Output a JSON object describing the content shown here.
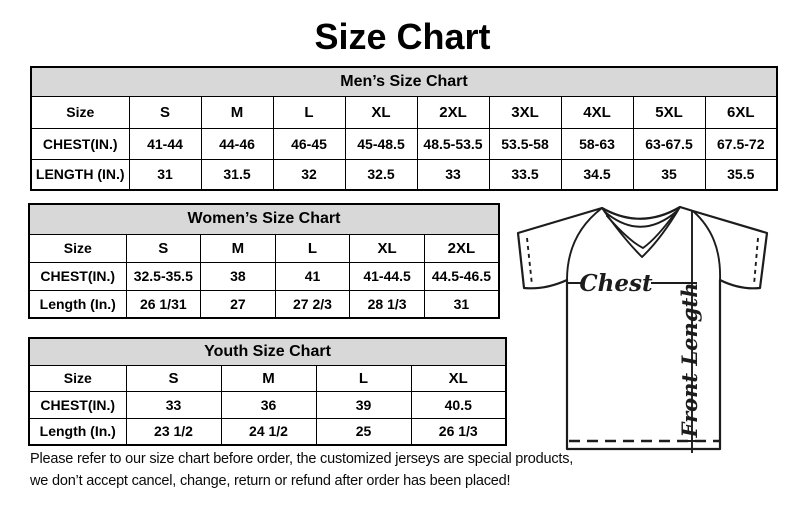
{
  "page": {
    "title": "Size Chart"
  },
  "tables": {
    "men": {
      "header": "Men’s Size Chart",
      "size_label": "Size",
      "sizes": [
        "S",
        "M",
        "L",
        "XL",
        "2XL",
        "3XL",
        "4XL",
        "5XL",
        "6XL"
      ],
      "rows": [
        {
          "label": "CHEST(IN.)",
          "values": [
            "41-44",
            "44-46",
            "46-45",
            "45-48.5",
            "48.5-53.5",
            "53.5-58",
            "58-63",
            "63-67.5",
            "67.5-72"
          ]
        },
        {
          "label": "LENGTH (IN.)",
          "values": [
            "31",
            "31.5",
            "32",
            "32.5",
            "33",
            "33.5",
            "34.5",
            "35",
            "35.5"
          ]
        }
      ]
    },
    "women": {
      "header": "Women’s Size Chart",
      "size_label": "Size",
      "sizes": [
        "S",
        "M",
        "L",
        "XL",
        "2XL"
      ],
      "rows": [
        {
          "label": "CHEST(IN.)",
          "values": [
            "32.5-35.5",
            "38",
            "41",
            "41-44.5",
            "44.5-46.5"
          ]
        },
        {
          "label": "Length (In.)",
          "values": [
            "26 1/31",
            "27",
            "27 2/3",
            "28 1/3",
            "31"
          ]
        }
      ]
    },
    "youth": {
      "header": "Youth Size Chart",
      "size_label": "Size",
      "sizes": [
        "S",
        "M",
        "L",
        "XL"
      ],
      "rows": [
        {
          "label": "CHEST(IN.)",
          "values": [
            "33",
            "36",
            "39",
            "40.5"
          ]
        },
        {
          "label": "Length (In.)",
          "values": [
            "23 1/2",
            "24 1/2",
            "25",
            "26 1/3"
          ]
        }
      ]
    }
  },
  "diagram": {
    "chest_label": "Chest",
    "front_length_label": "Front Length"
  },
  "footer": {
    "line1": "Please refer to our size chart before order, the customized jerseys are special products,",
    "line2": "we don’t accept cancel, change, return or refund after order has been placed!"
  },
  "colors": {
    "table_header_bg": "#d8d8d8",
    "border": "#000000",
    "text": "#000000"
  }
}
